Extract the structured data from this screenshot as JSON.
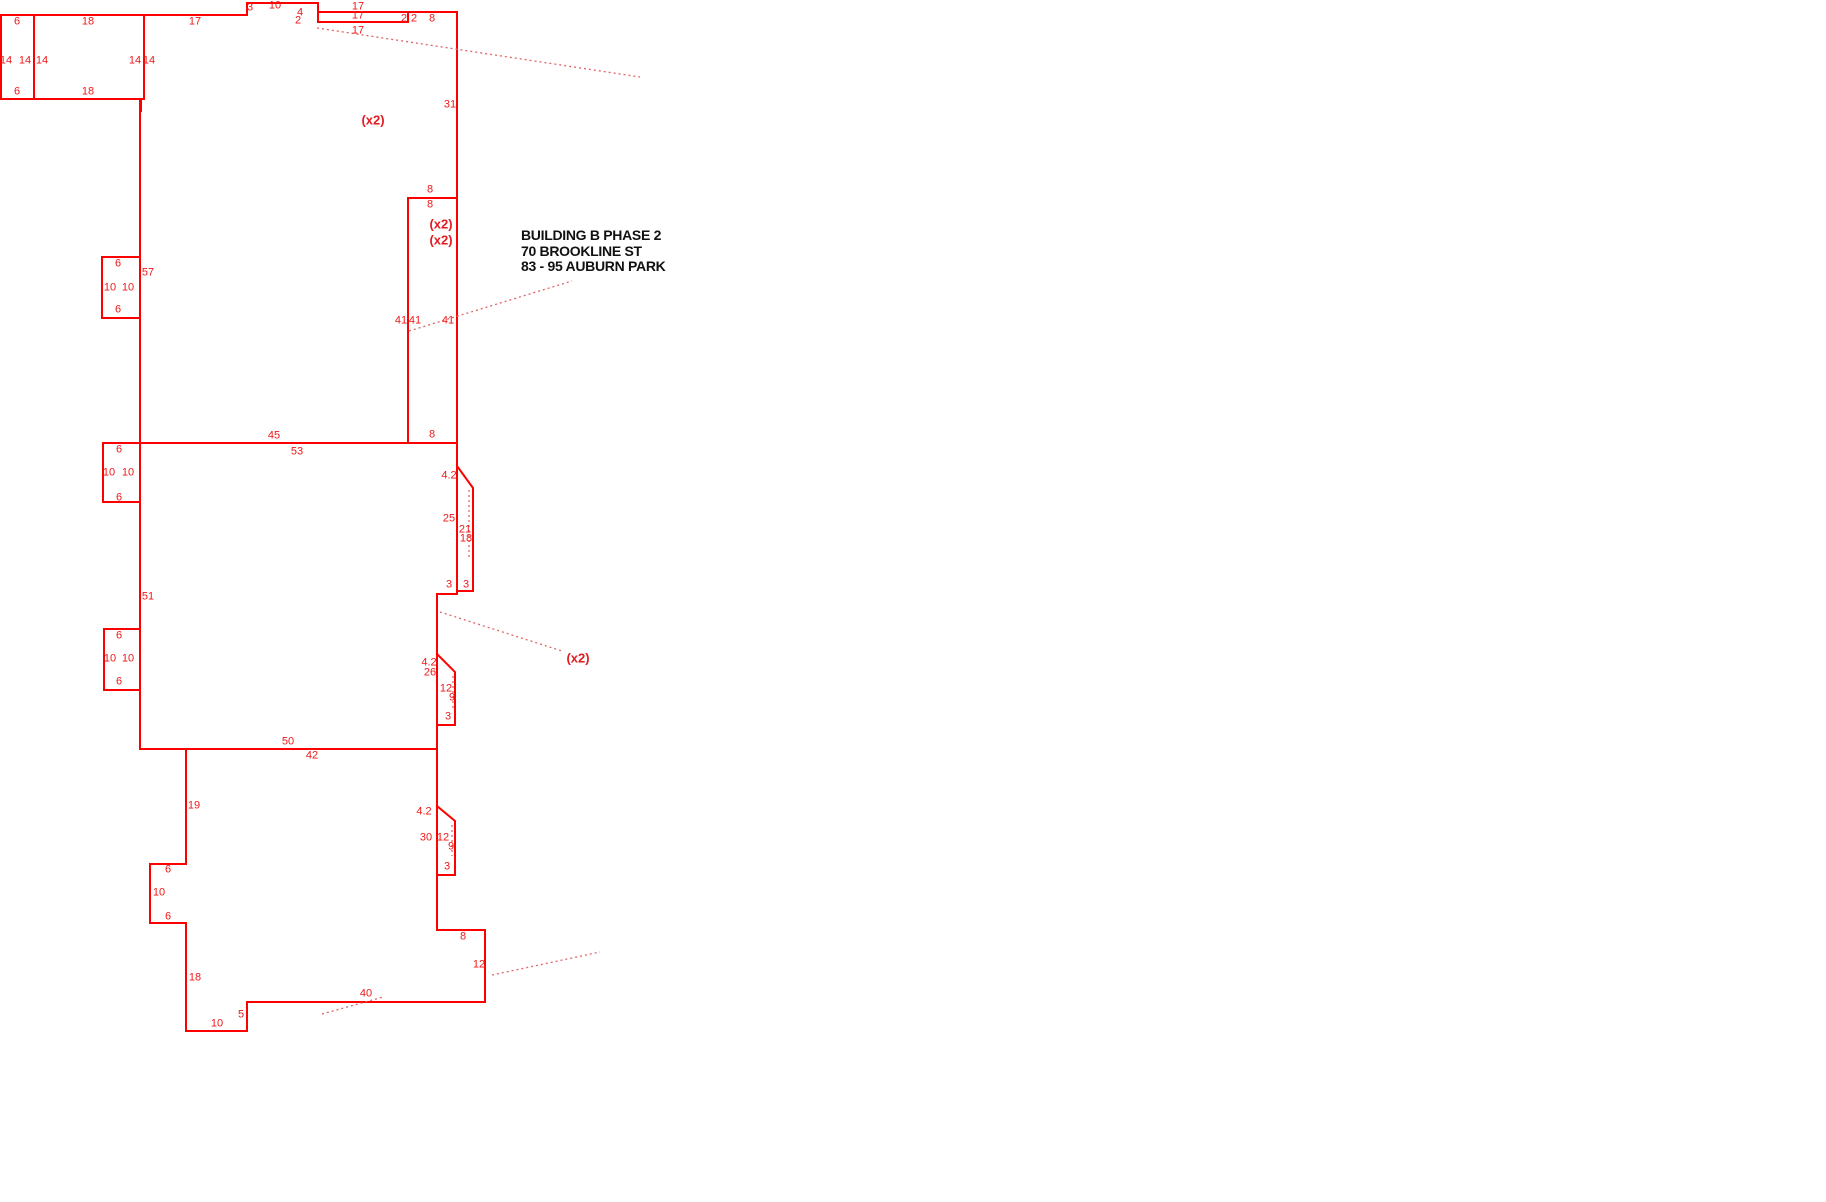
{
  "drawing": {
    "building_label": {
      "line1": "BUILDING B PHASE 2",
      "line2": "70 BROOKLINE ST",
      "line3": "83 - 95 AUBURN PARK"
    },
    "colors": {
      "outline": "#ff0000",
      "leader": "#e06666",
      "dimension_text": "#f01818",
      "annotation_text": "#111111"
    },
    "labels": [
      {
        "t": "6",
        "x": 17,
        "y": 22
      },
      {
        "t": "18",
        "x": 88,
        "y": 22
      },
      {
        "t": "17",
        "x": 195,
        "y": 22
      },
      {
        "t": "14",
        "x": 6,
        "y": 61
      },
      {
        "t": "14",
        "x": 25,
        "y": 61
      },
      {
        "t": "14",
        "x": 42,
        "y": 61
      },
      {
        "t": "14",
        "x": 135,
        "y": 61
      },
      {
        "t": "14",
        "x": 149,
        "y": 61
      },
      {
        "t": "6",
        "x": 17,
        "y": 92
      },
      {
        "t": "18",
        "x": 88,
        "y": 92
      },
      {
        "t": "3",
        "x": 250,
        "y": 8
      },
      {
        "t": "10",
        "x": 275,
        "y": 6
      },
      {
        "t": "4",
        "x": 300,
        "y": 13
      },
      {
        "t": "2",
        "x": 298,
        "y": 21
      },
      {
        "t": "17",
        "x": 358,
        "y": 7
      },
      {
        "t": "17",
        "x": 358,
        "y": 16
      },
      {
        "t": "17",
        "x": 358,
        "y": 31
      },
      {
        "t": "2",
        "x": 404,
        "y": 19
      },
      {
        "t": "2",
        "x": 414,
        "y": 19
      },
      {
        "t": "8",
        "x": 432,
        "y": 19
      },
      {
        "t": "31",
        "x": 450,
        "y": 105
      },
      {
        "t": "(x2)",
        "x": 373,
        "y": 120,
        "k": "mult"
      },
      {
        "t": "8",
        "x": 430,
        "y": 190
      },
      {
        "t": "8",
        "x": 430,
        "y": 205
      },
      {
        "t": "(x2)",
        "x": 441,
        "y": 224,
        "k": "mult"
      },
      {
        "t": "(x2)",
        "x": 441,
        "y": 240,
        "k": "mult"
      },
      {
        "t": "41",
        "x": 401,
        "y": 321
      },
      {
        "t": "41",
        "x": 415,
        "y": 321
      },
      {
        "t": "41",
        "x": 448,
        "y": 321
      },
      {
        "t": "8",
        "x": 432,
        "y": 435
      },
      {
        "t": "6",
        "x": 118,
        "y": 264
      },
      {
        "t": "57",
        "x": 148,
        "y": 273
      },
      {
        "t": "10",
        "x": 110,
        "y": 288
      },
      {
        "t": "10",
        "x": 128,
        "y": 288
      },
      {
        "t": "6",
        "x": 118,
        "y": 310
      },
      {
        "t": "45",
        "x": 274,
        "y": 436
      },
      {
        "t": "53",
        "x": 297,
        "y": 452
      },
      {
        "t": "6",
        "x": 119,
        "y": 450
      },
      {
        "t": "10",
        "x": 109,
        "y": 473
      },
      {
        "t": "10",
        "x": 128,
        "y": 473
      },
      {
        "t": "6",
        "x": 119,
        "y": 498
      },
      {
        "t": "4.2",
        "x": 449,
        "y": 476
      },
      {
        "t": "25",
        "x": 449,
        "y": 519
      },
      {
        "t": "21",
        "x": 465,
        "y": 530
      },
      {
        "t": "18",
        "x": 466,
        "y": 539
      },
      {
        "t": "3",
        "x": 449,
        "y": 585
      },
      {
        "t": "3",
        "x": 466,
        "y": 585
      },
      {
        "t": "51",
        "x": 148,
        "y": 597
      },
      {
        "t": "6",
        "x": 119,
        "y": 636
      },
      {
        "t": "10",
        "x": 110,
        "y": 659
      },
      {
        "t": "10",
        "x": 128,
        "y": 659
      },
      {
        "t": "6",
        "x": 119,
        "y": 682
      },
      {
        "t": "(x2)",
        "x": 578,
        "y": 658,
        "k": "mult"
      },
      {
        "t": "4.2",
        "x": 429,
        "y": 663
      },
      {
        "t": "26",
        "x": 430,
        "y": 673
      },
      {
        "t": "12",
        "x": 446,
        "y": 689
      },
      {
        "t": "9",
        "x": 452,
        "y": 698
      },
      {
        "t": "3",
        "x": 448,
        "y": 717
      },
      {
        "t": "50",
        "x": 288,
        "y": 742
      },
      {
        "t": "42",
        "x": 312,
        "y": 756
      },
      {
        "t": "19",
        "x": 194,
        "y": 806
      },
      {
        "t": "4.2",
        "x": 424,
        "y": 812
      },
      {
        "t": "30",
        "x": 426,
        "y": 838
      },
      {
        "t": "12",
        "x": 443,
        "y": 838
      },
      {
        "t": "9",
        "x": 451,
        "y": 847
      },
      {
        "t": "3",
        "x": 447,
        "y": 867
      },
      {
        "t": "6",
        "x": 168,
        "y": 870
      },
      {
        "t": "10",
        "x": 159,
        "y": 893
      },
      {
        "t": "6",
        "x": 168,
        "y": 917
      },
      {
        "t": "18",
        "x": 195,
        "y": 978
      },
      {
        "t": "8",
        "x": 463,
        "y": 937
      },
      {
        "t": "12",
        "x": 479,
        "y": 965
      },
      {
        "t": "40",
        "x": 366,
        "y": 994
      },
      {
        "t": "5",
        "x": 241,
        "y": 1015
      },
      {
        "t": "10",
        "x": 217,
        "y": 1024
      }
    ]
  }
}
